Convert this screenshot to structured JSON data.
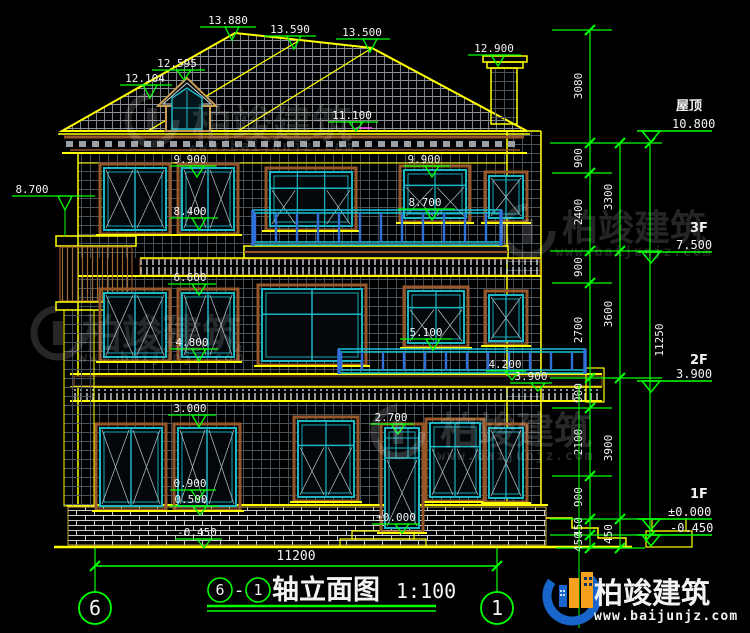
{
  "drawing": {
    "colors": {
      "background": "#000000",
      "outline_yellow": "#ffff00",
      "annotation_green": "#00ff00",
      "frame_teal": "#1fb6c4",
      "casing_brown": "#96582a",
      "rail_blue": "#2f6fd6",
      "rail_cyan": "#19c3d6",
      "text": "#f2f3f4",
      "logo_blue": "#1866cc",
      "logo_orange": "#f7a01e"
    },
    "elevation_markers": [
      "13.880",
      "13.590",
      "13.500",
      "12.900",
      "12.595",
      "12.104",
      "11.100",
      "9.900",
      "9.900",
      "8.700",
      "8.400",
      "8.700",
      "6.600",
      "5.100",
      "4.800",
      "4.200",
      "3.900",
      "3.000",
      "2.700",
      "0.900",
      "0.500",
      "±0.000",
      "-0.450"
    ],
    "floor_levels": [
      {
        "label": "屋顶",
        "value": "10.800"
      },
      {
        "label": "3F",
        "value": "7.500"
      },
      {
        "label": "2F",
        "value": "3.900"
      },
      {
        "label": "1F",
        "value": "±0.000"
      },
      {
        "label": "",
        "value": "-0.450"
      }
    ],
    "dim_chain": {
      "inner": [
        "3080",
        "900",
        "2400",
        "900",
        "2700",
        "900",
        "2100",
        "900",
        "450",
        "450"
      ],
      "mid": [
        "3300",
        "3600",
        "3900",
        "450"
      ],
      "outer": [
        "11250"
      ]
    },
    "bottom": {
      "span_dim": "11200",
      "axis_left": "6",
      "axis_right": "1"
    },
    "title": {
      "axis_start": "6",
      "separator": "-",
      "axis_end": "1",
      "text": "轴立面图",
      "scale": "1:100"
    },
    "brand": {
      "name": "柏竣建筑",
      "url": "www.baijunjz.com"
    }
  }
}
